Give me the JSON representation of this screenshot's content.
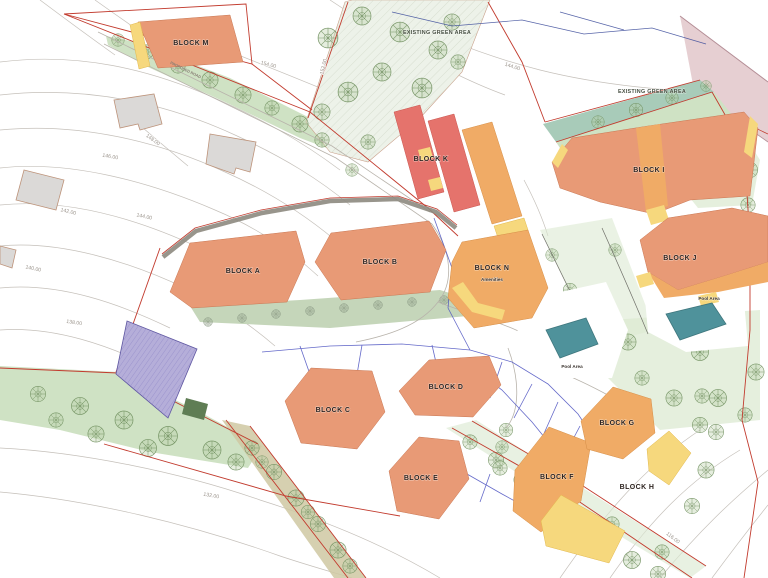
{
  "blocks": [
    {
      "id": "m",
      "label": "BLOCK M"
    },
    {
      "id": "k",
      "label": "BLOCK K"
    },
    {
      "id": "i",
      "label": "BLOCK I"
    },
    {
      "id": "j",
      "label": "BLOCK J"
    },
    {
      "id": "a",
      "label": "BLOCK A"
    },
    {
      "id": "b",
      "label": "BLOCK B"
    },
    {
      "id": "n",
      "label": "BLOCK N",
      "sublabel": "Amenities"
    },
    {
      "id": "c",
      "label": "BLOCK C"
    },
    {
      "id": "d",
      "label": "BLOCK D"
    },
    {
      "id": "e",
      "label": "BLOCK E"
    },
    {
      "id": "f",
      "label": "BLOCK F"
    },
    {
      "id": "g",
      "label": "BLOCK G"
    },
    {
      "id": "h",
      "label": "BLOCK H"
    }
  ],
  "areas": {
    "existing_green_top": "EXISTING GREEN AREA",
    "existing_green_right": "EXISTING GREEN AREA",
    "pool_center": "Pool Area",
    "pool_right": "Pool Area",
    "proposed_road": "PROPOSED ROAD"
  },
  "contours": [
    {
      "value": "154.00"
    },
    {
      "value": "152.00"
    },
    {
      "value": "144.00"
    },
    {
      "value": "148.00"
    },
    {
      "value": "146.00"
    },
    {
      "value": "144.00"
    },
    {
      "value": "142.00"
    },
    {
      "value": "140.00"
    },
    {
      "value": "138.00"
    },
    {
      "value": "132.00"
    },
    {
      "value": "116.00"
    }
  ],
  "colors": {
    "salmon": "#e89a76",
    "coral_red": "#e5736c",
    "orange": "#f0ab66",
    "yellow": "#f6d87d",
    "pool_teal": "#4f929b",
    "green_area": "#cfe2c4",
    "tree_green": "#6f8f5e",
    "teal_band": "#a8cbb9",
    "purple": "#b5aed9",
    "pink": "#e6cfd2",
    "boundary_red": "#c23b2e",
    "utility_blue": "#4a50c0",
    "contour_gray": "#c5c0ba",
    "existing_building": "#dbd9d7"
  }
}
